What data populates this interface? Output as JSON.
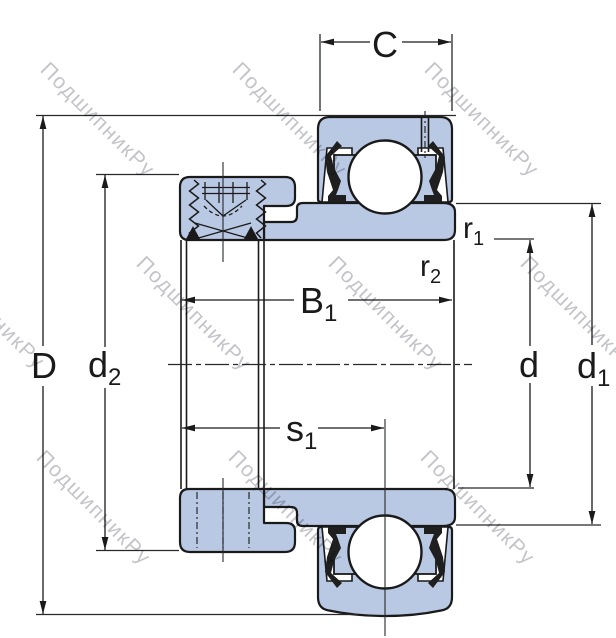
{
  "drawing": {
    "title": "insert-bearing-cross-section",
    "colors": {
      "part_fill": "#bac9e3",
      "outline": "#1a1a1a",
      "dim_line": "#26282a",
      "watermark": "#c6c7cb"
    }
  },
  "dimensions": {
    "C": {
      "main": "C",
      "sub": ""
    },
    "D": {
      "main": "D",
      "sub": ""
    },
    "d2": {
      "main": "d",
      "sub": "2"
    },
    "B1": {
      "main": "B",
      "sub": "1"
    },
    "s1": {
      "main": "s",
      "sub": "1"
    },
    "r1": {
      "main": "r",
      "sub": "1"
    },
    "r2": {
      "main": "r",
      "sub": "2"
    },
    "d": {
      "main": "d",
      "sub": ""
    },
    "d1": {
      "main": "d",
      "sub": "1"
    }
  },
  "watermark": {
    "text": "ПодшипникРу"
  }
}
